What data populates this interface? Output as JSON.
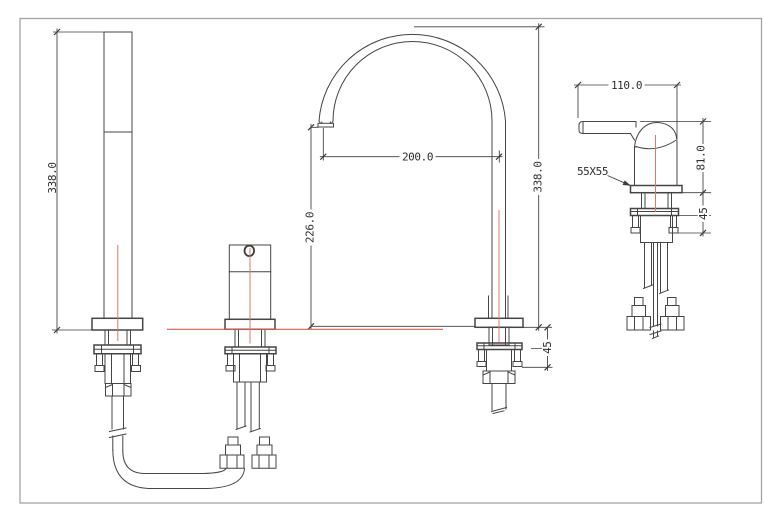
{
  "drawing": {
    "type": "technical-drawing-faucet-3-hole-mixer",
    "colors": {
      "frame": "#a3a3a3",
      "line": "#454545",
      "dimension": "#3d3d3d",
      "centerline": "#e0766d",
      "datum_line": "#d95f53",
      "text": "#2d2d2d",
      "background": "#ffffff"
    },
    "views": {
      "hand_shower": {
        "label": "hand-shower-front-view",
        "height": "338.0"
      },
      "diverter": {
        "label": "diverter-valve-front-view"
      },
      "spout": {
        "label": "arch-spout-front-view",
        "reach": "200.0",
        "outlet_height": "226.0",
        "height": "338.0",
        "max_deck_thickness": "45"
      },
      "mixer": {
        "label": "mixer-handle-side-view",
        "handle_length": "110.0",
        "body_height": "81.0",
        "base_plate": "55X55",
        "max_deck_thickness": "45"
      }
    }
  }
}
